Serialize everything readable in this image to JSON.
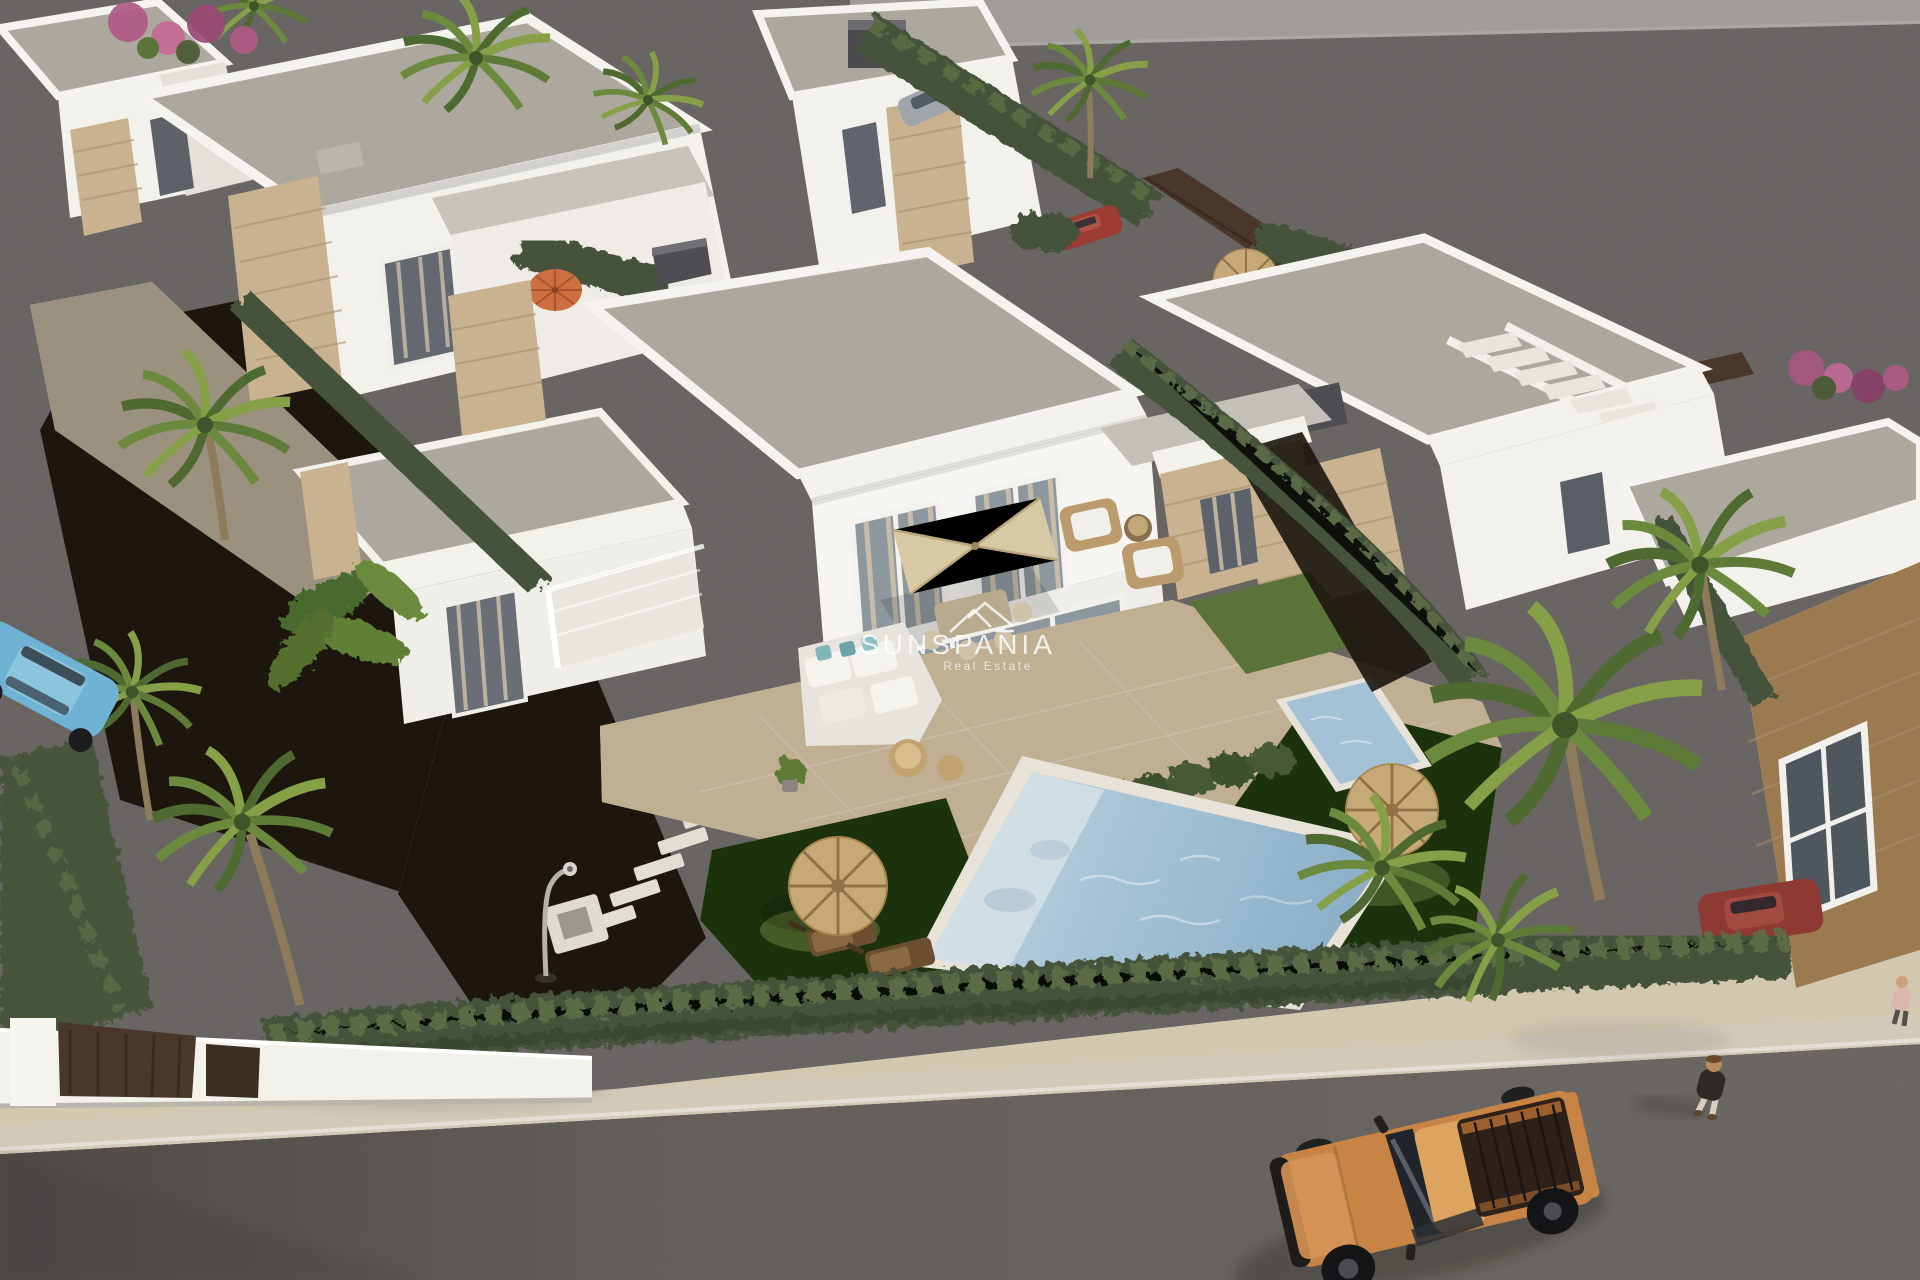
{
  "watermark": {
    "brand": "SUNSPANIA",
    "tagline": "Real Estate",
    "logo_icon": "mountain-peaks-icon"
  },
  "scene": {
    "alt_text": "Aerial 3D architectural render of a development of white flat-roofed villas with stone accents, private pools, lawns, palm trees and hedges; an orange pickup truck and a pedestrian on the street below"
  },
  "palette": {
    "pavement": "#a5a1a0",
    "road": "#a09c99",
    "sidewalk": "#e9e3d4",
    "gravel": "#585049",
    "path": "#c8c1b5",
    "wall_white": "#f3f1ec",
    "roof_gray": "#d3d0ca",
    "stone_beige": "#c8b290",
    "hedge_green": "#46543a",
    "lawn_green": "#5b7338",
    "palm_green": "#55702f",
    "pool_water": "#9cbfd6",
    "pool_shelf": "#d5e0e5",
    "parasol_cream": "#d9c8a4",
    "straw_tan": "#c7a877",
    "umbrella_orange": "#cc7040",
    "truck_orange": "#c88445",
    "fence_brown": "#4a3729",
    "chimney_gray": "#4e4e52",
    "car_blue": "#6fb2d4",
    "car_red": "#9c3c34",
    "glass_gray": "#8d989e",
    "curtain_beige": "#cbbfa9"
  }
}
